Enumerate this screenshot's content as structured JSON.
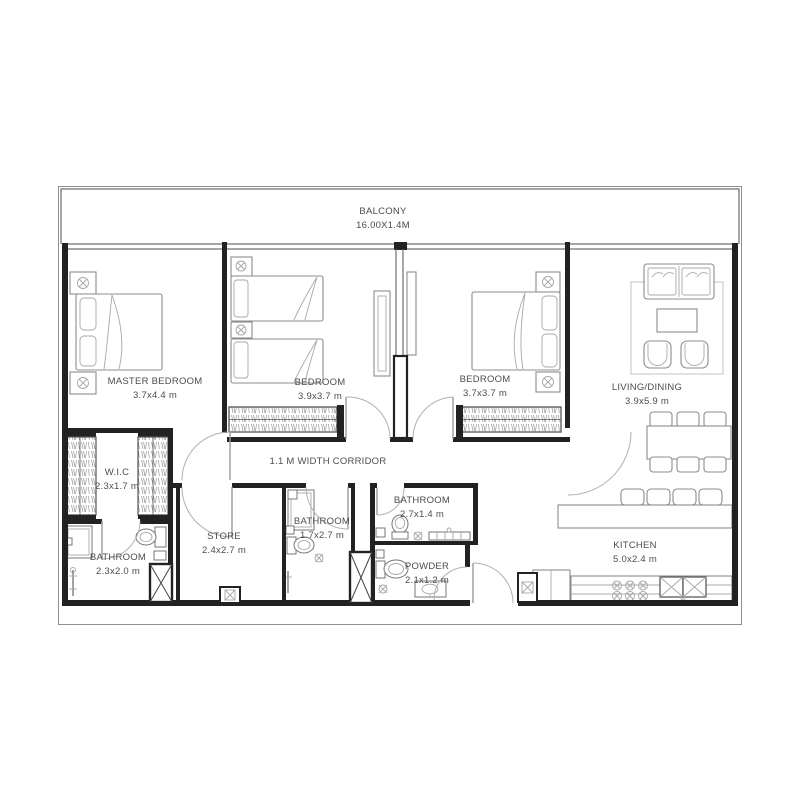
{
  "plan": {
    "balcony": {
      "name": "BALCONY",
      "dims": "16.00X1.4M"
    },
    "master_bedroom": {
      "name": "MASTER BEDROOM",
      "dims": "3.7x4.4 m"
    },
    "bedroom_2": {
      "name": "BEDROOM",
      "dims": "3.9x3.7 m"
    },
    "bedroom_3": {
      "name": "BEDROOM",
      "dims": "3.7x3.7 m"
    },
    "living_dining": {
      "name": "LIVING/DINING",
      "dims": "3.9x5.9 m"
    },
    "wic": {
      "name": "W.I.C",
      "dims": "2.3x1.7 m"
    },
    "corridor": {
      "name": "1.1 M WIDTH CORRIDOR"
    },
    "bathroom_master": {
      "name": "BATHROOM",
      "dims": "2.3x2.0 m"
    },
    "store": {
      "name": "STORE",
      "dims": "2.4x2.7 m"
    },
    "bathroom_shared": {
      "name": "BATHROOM",
      "dims": "1.7x2.7 m"
    },
    "bathroom_guest": {
      "name": "BATHROOM",
      "dims": "2.7x1.4 m"
    },
    "powder": {
      "name": "POWDER",
      "dims": "2.1x1.2 m"
    },
    "kitchen": {
      "name": "KITCHEN",
      "dims": "5.0x2.4 m"
    }
  },
  "colors": {
    "wall": "#222222",
    "furniture_line": "#8c8c8c",
    "text": "#4d4d4d",
    "background": "#ffffff"
  }
}
